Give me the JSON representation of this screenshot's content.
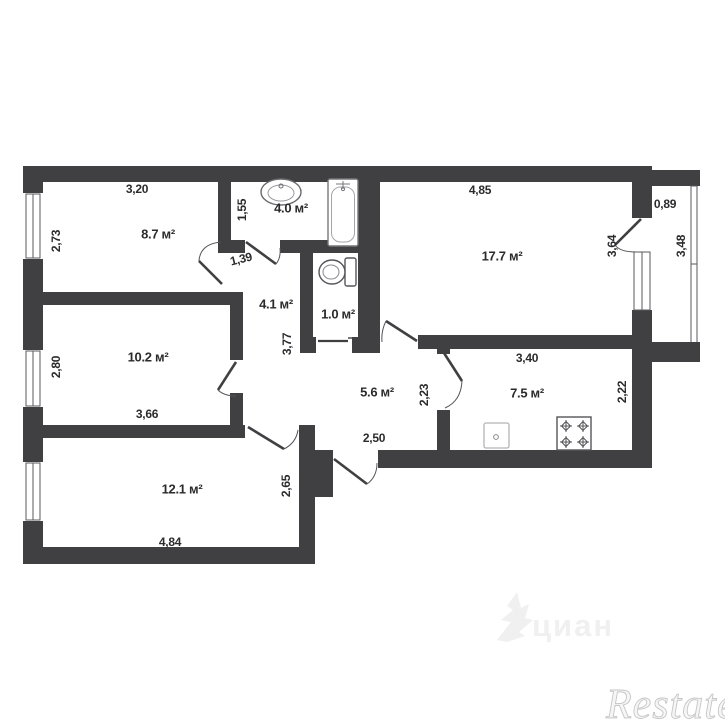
{
  "plan": {
    "title": "apartment-floor-plan",
    "units": "м²",
    "rooms": {
      "bedroom1": {
        "area": "8.7 м²",
        "width": "3,20",
        "side": "2,73"
      },
      "bathroom": {
        "area": "4.0 м²",
        "side": "1,55"
      },
      "hall": {
        "area": "4.1 м²",
        "side": "3,77",
        "door_width": "1,39"
      },
      "wc": {
        "area": "1.0 м²"
      },
      "living": {
        "area": "17.7 м²",
        "width": "4,85",
        "side": "3,64"
      },
      "balcony": {
        "width": "0,89",
        "side": "3,48"
      },
      "bedroom2": {
        "area": "10.2 м²",
        "width": "3,66",
        "side": "2,80"
      },
      "corridor": {
        "area": "5.6 м²",
        "width": "2,50",
        "side": "2,23"
      },
      "kitchen": {
        "area": "7.5 м²",
        "width": "3,40",
        "side": "2,22"
      },
      "bedroom3": {
        "area": "12.1 м²",
        "width": "4,84",
        "side": "2,65"
      }
    },
    "colors": {
      "wall": "#404043",
      "fixture": "#6a6a6e",
      "text": "#2b2b2d",
      "watermark_light": "#f0f0f0",
      "watermark_gray": "#c6c6c6"
    },
    "watermarks": {
      "portal": "циан",
      "agency": "Restate"
    }
  }
}
